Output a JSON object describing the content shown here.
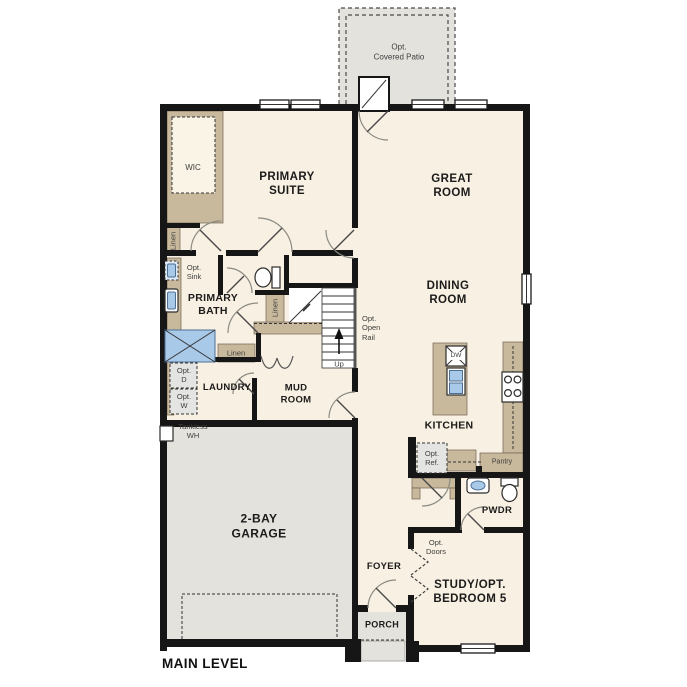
{
  "plan": {
    "title": "MAIN LEVEL",
    "labels": {
      "covered_patio": "Opt.\nCovered Patio",
      "wic": "WIC",
      "primary_suite": "PRIMARY\nSUITE",
      "great_room": "GREAT\nROOM",
      "linen_left": "Linen",
      "opt_sink": "Opt.\nSink",
      "primary_bath": "PRIMARY\nBATH",
      "linen_stair": "Linen",
      "linen_hall": "Linen",
      "dining_room": "DINING\nROOM",
      "opt_open_rail": "Opt.\nOpen\nRail",
      "up": "Up",
      "opt_dryer": "Opt.\nD",
      "opt_washer": "Opt.\nW",
      "laundry": "LAUNDRY",
      "mud_room": "MUD\nROOM",
      "tankless_wh": "Tankless\nWH",
      "garage": "2-BAY\nGARAGE",
      "dishwasher": "DW",
      "kitchen": "KITCHEN",
      "opt_ref": "Opt.\nRef.",
      "pantry": "Pantry",
      "powder": "PWDR",
      "foyer": "FOYER",
      "opt_doors": "Opt.\nDoors",
      "study": "STUDY/OPT.\nBEDROOM 5",
      "porch": "PORCH"
    },
    "colors": {
      "floor": "#f8f0e2",
      "exterior": "#e3e2dd",
      "cabinet": "#c9b99c",
      "fixture_blue": "#a9c9e9",
      "wall": "#161616"
    }
  }
}
